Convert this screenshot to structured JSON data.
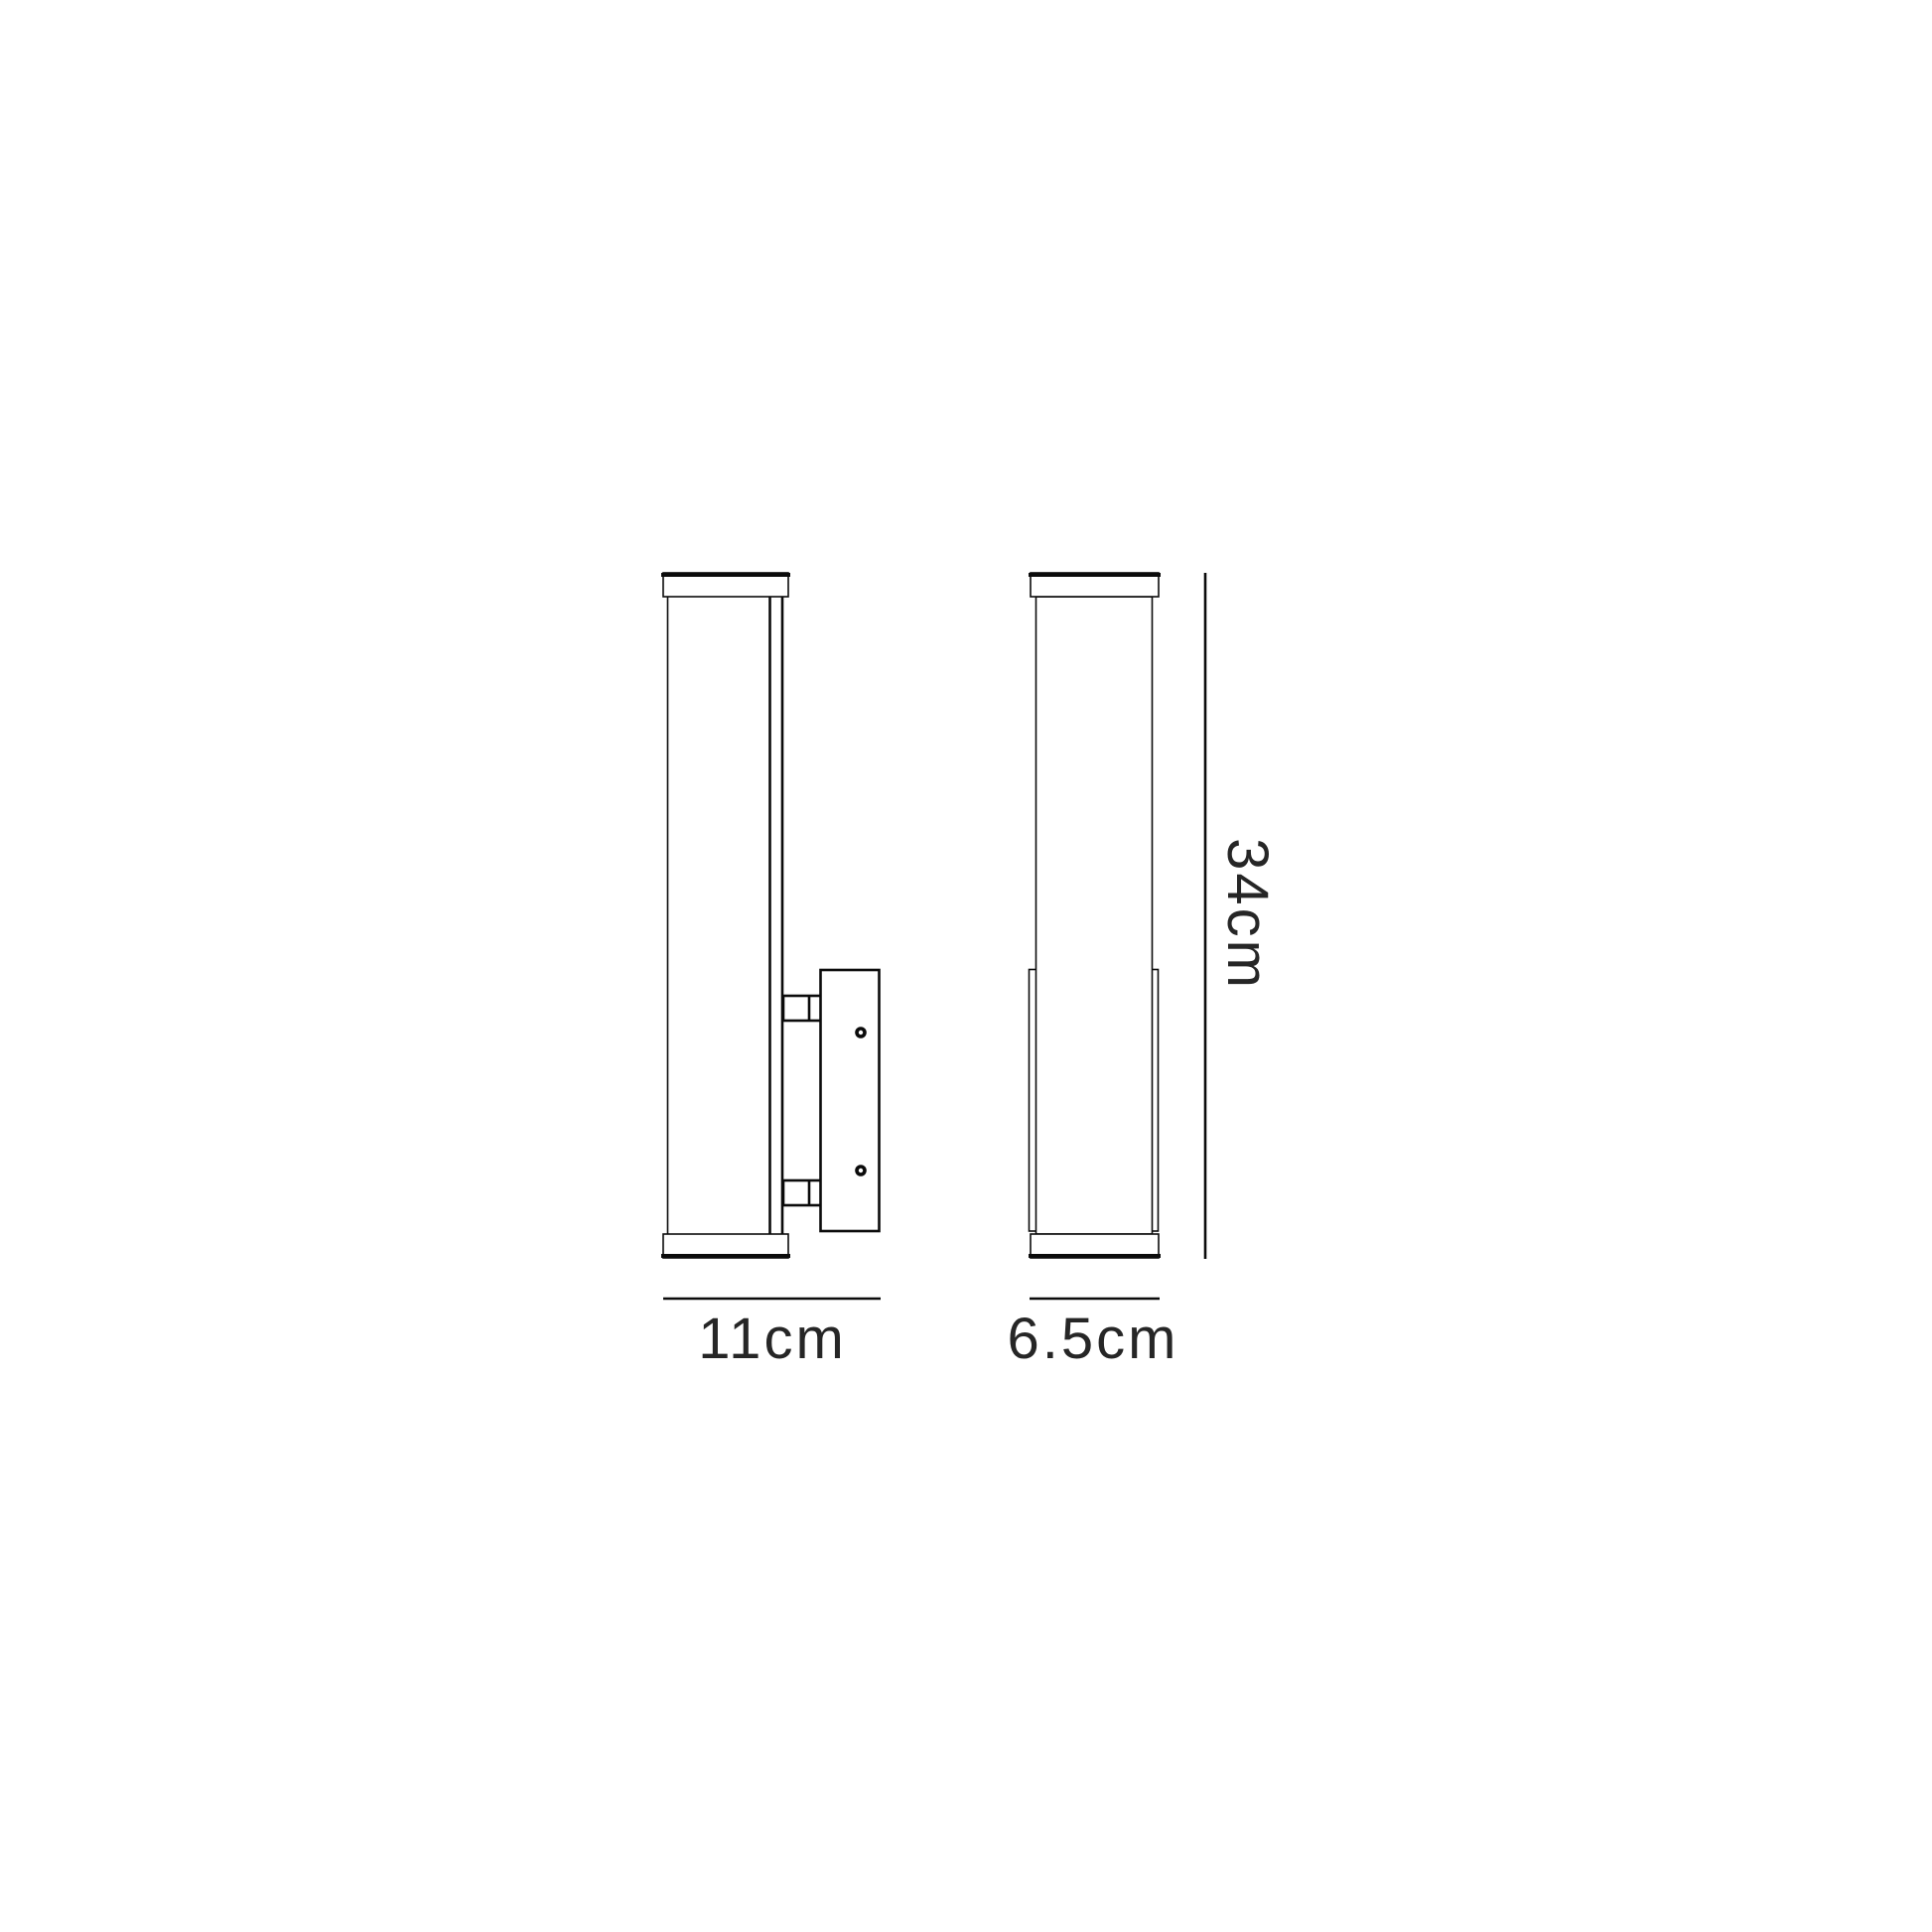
{
  "diagram": {
    "dimension_labels": {
      "front_view_width": "11cm",
      "side_view_width": "6.5cm",
      "height": "34cm"
    },
    "colors": {
      "line": "#0b0b0b",
      "text": "#262626",
      "background": "#ffffff"
    }
  }
}
